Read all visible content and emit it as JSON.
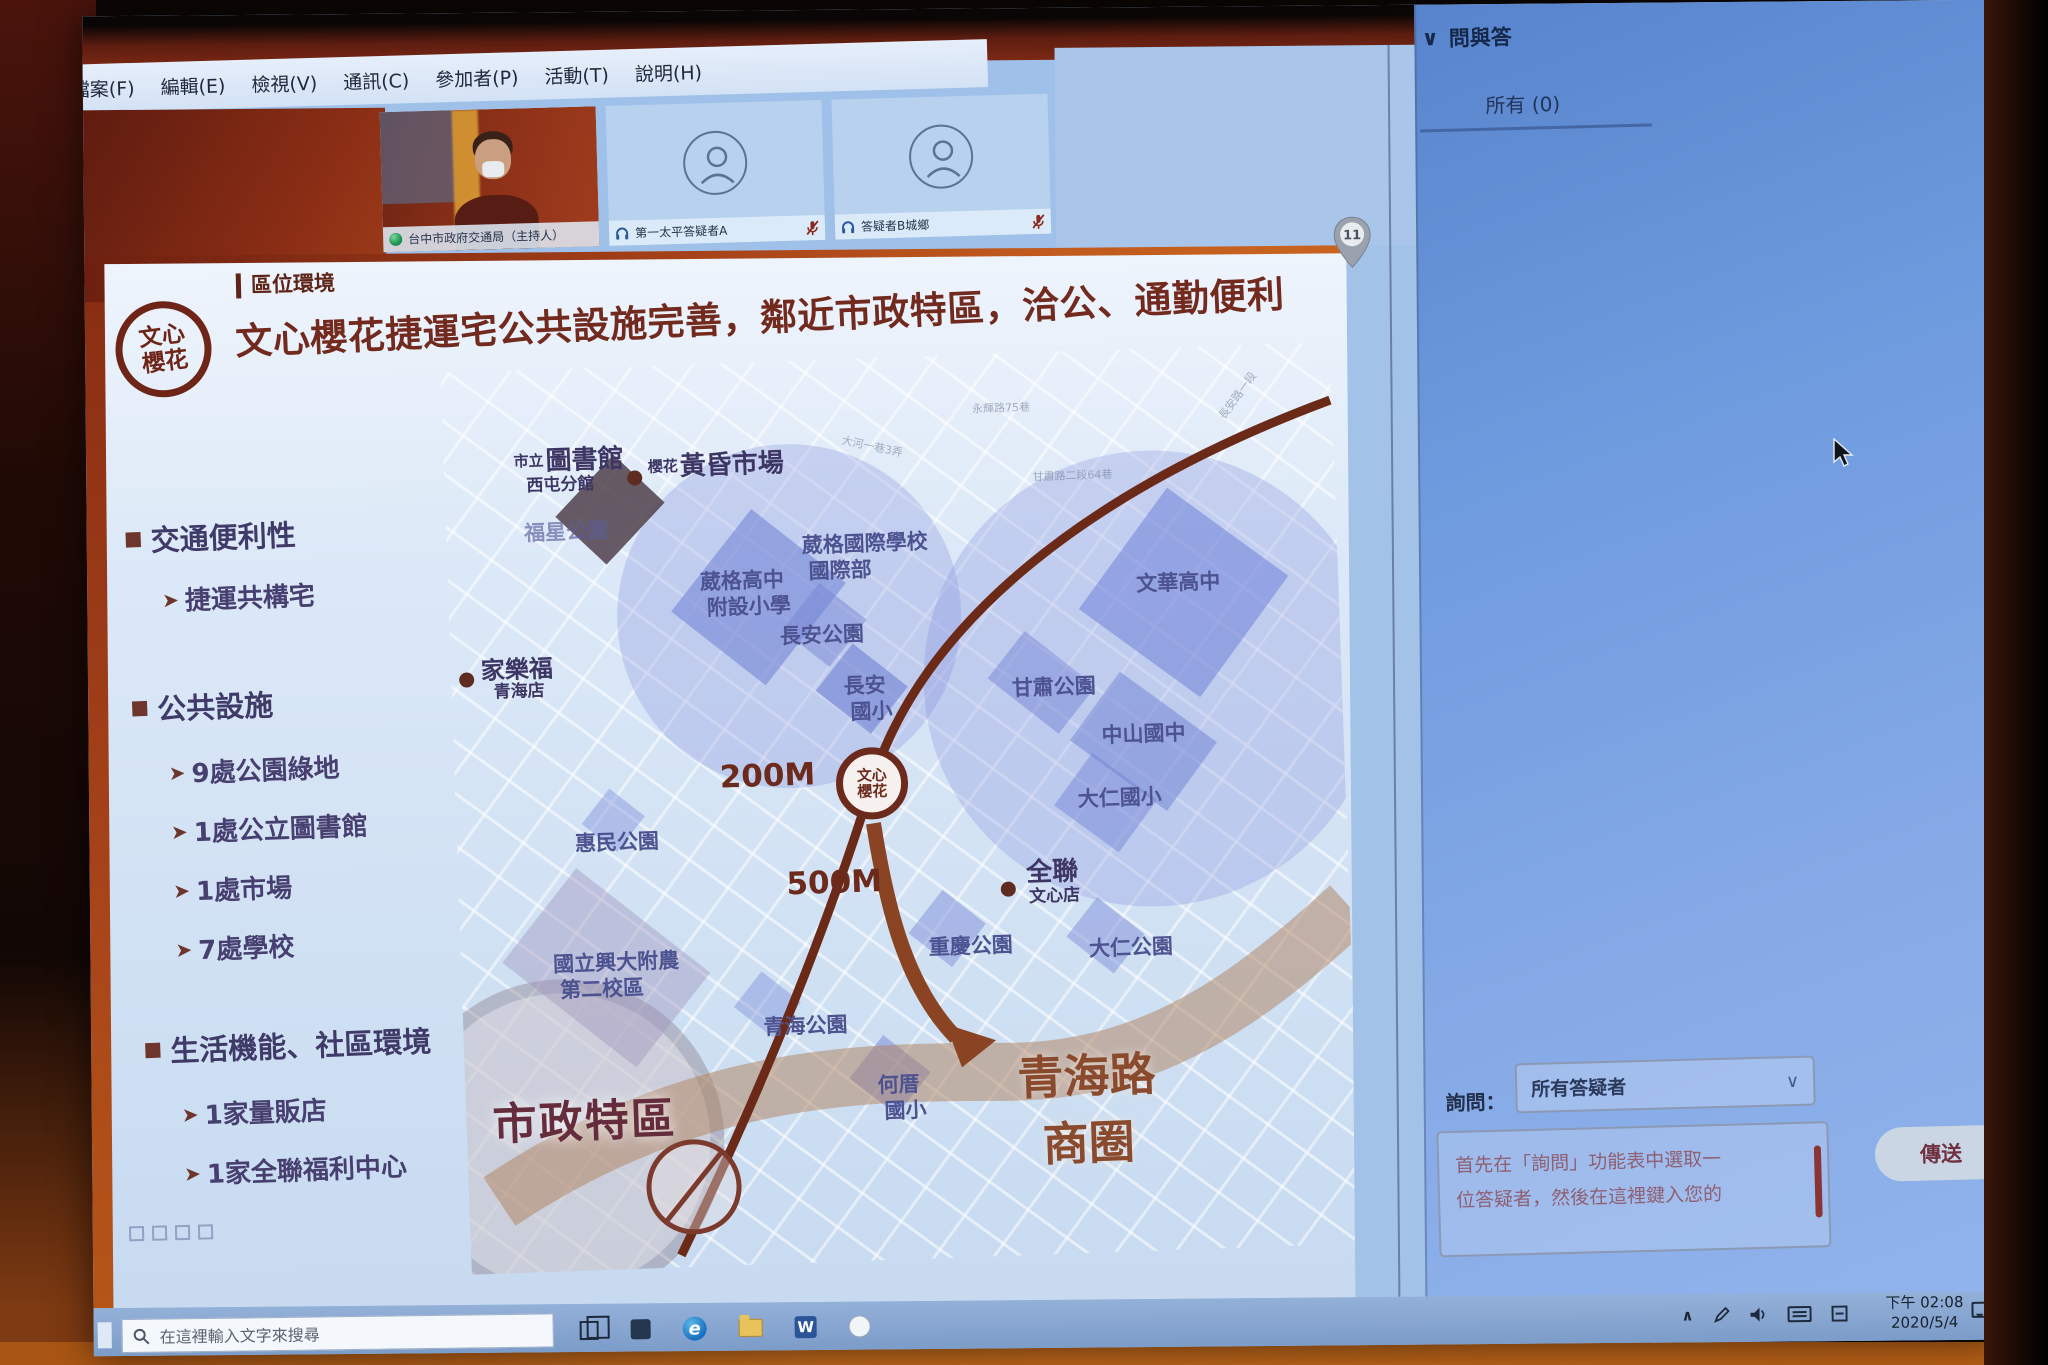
{
  "webex": {
    "menu_items": [
      "檔案(F)",
      "編輯(E)",
      "檢視(V)",
      "通訊(C)",
      "參加者(P)",
      "活動(T)",
      "說明(H)"
    ],
    "participants": [
      {
        "name": "台中市政府交通局（主持人）"
      },
      {
        "name": "第一太平答疑者A"
      },
      {
        "name": "答疑者B城鄉"
      }
    ]
  },
  "slide": {
    "logo": {
      "line1": "文心",
      "line2": "櫻花"
    },
    "kicker": "區位環境",
    "title": "文心櫻花捷運宅公共設施完善，鄰近市政特區，洽公、通勤便利",
    "sections": [
      {
        "header": "交通便利性",
        "items": [
          "捷運共構宅"
        ]
      },
      {
        "header": "公共設施",
        "items": [
          "9處公園綠地",
          "1處公立圖書館",
          "1處市場",
          "7處學校"
        ]
      },
      {
        "header": "生活機能、社區環境",
        "items": [
          "1家量販店",
          "1家全聯福利中心"
        ]
      }
    ],
    "map": {
      "station": {
        "line1": "文心",
        "line2": "櫻花"
      },
      "distance_200": "200M",
      "distance_500": "500M",
      "library": {
        "prefix": "市立",
        "main": "圖書館",
        "sub": "西屯分館"
      },
      "market": {
        "prefix": "櫻花",
        "main": "黃昏市場"
      },
      "carrefour": {
        "main": "家樂福",
        "sub": "青海店"
      },
      "pxmart": {
        "main": "全聯",
        "sub": "文心店"
      },
      "labels": [
        {
          "t1": "福星公園",
          "t2": ""
        },
        {
          "t1": "葳格國際學校",
          "t2": "國際部"
        },
        {
          "t1": "葳格高中",
          "t2": "附設小學"
        },
        {
          "t1": "長安公園",
          "t2": ""
        },
        {
          "t1": "長安",
          "t2": "國小"
        },
        {
          "t1": "甘肅公園",
          "t2": ""
        },
        {
          "t1": "文華高中",
          "t2": ""
        },
        {
          "t1": "中山國中",
          "t2": ""
        },
        {
          "t1": "大仁國小",
          "t2": ""
        },
        {
          "t1": "惠民公園",
          "t2": ""
        },
        {
          "t1": "國立興大附農",
          "t2": "第二校區"
        },
        {
          "t1": "青海公園",
          "t2": ""
        },
        {
          "t1": "何厝",
          "t2": "國小"
        },
        {
          "t1": "重慶公園",
          "t2": ""
        },
        {
          "t1": "大仁公園",
          "t2": ""
        }
      ],
      "big_labels": {
        "civic": "市政特區",
        "qinghai_line1": "青海路",
        "qinghai_line2": "商圈"
      },
      "streets": [
        "永輝路75巷",
        "大河一巷3弄",
        "甘肅路二段64巷",
        "長安路一段"
      ],
      "pin_label": "11"
    }
  },
  "qa": {
    "header": "問與答",
    "tab_all": "所有 (0)",
    "ask_label": "詢問：",
    "ask_target": "所有答疑者",
    "placeholder_line1": "首先在「詢問」功能表中選取一",
    "placeholder_line2": "位答疑者，然後在這裡鍵入您的",
    "send_label": "傳送"
  },
  "taskbar": {
    "search_placeholder": "在這裡輸入文字來搜尋",
    "time": "下午 02:08",
    "date": "2020/5/4"
  },
  "icons": {
    "chevron_down": "∨",
    "tray_chevron": "∧"
  },
  "colors": {
    "accent_red": "#732a1e",
    "accent_purple": "#433c6e",
    "qa_blue": "#6f9bdf",
    "curtain_orange": "#c26a1c"
  }
}
